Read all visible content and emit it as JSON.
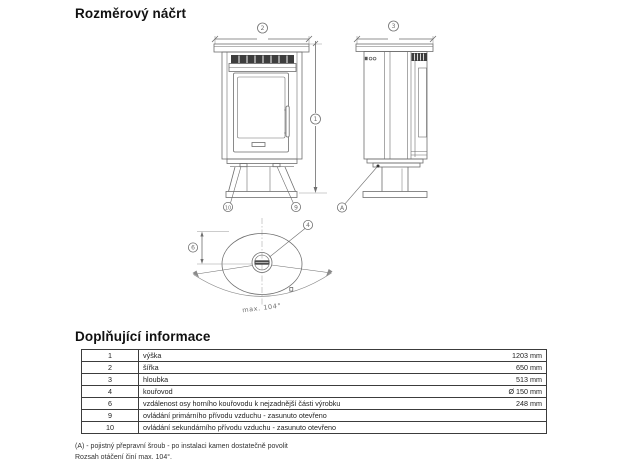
{
  "page": {
    "title": "Rozměrový náčrt",
    "section_title": "Doplňující informace"
  },
  "drawing": {
    "callouts": {
      "height": "1",
      "width": "2",
      "depth": "3",
      "flue": "4",
      "offset": "6",
      "primary_air": "9",
      "secondary_air": "10",
      "transport_screw": "A"
    },
    "rotation_label": "max. 104°"
  },
  "table": {
    "rows": [
      {
        "num": "1",
        "label": "výška",
        "value": "1203 mm"
      },
      {
        "num": "2",
        "label": "šířka",
        "value": "650 mm"
      },
      {
        "num": "3",
        "label": "hloubka",
        "value": "513 mm"
      },
      {
        "num": "4",
        "label": "kouřovod",
        "value": "Ø 150 mm"
      },
      {
        "num": "6",
        "label": "vzdálenost osy horního kouřovodu k nejzadnější části výrobku",
        "value": "248 mm"
      },
      {
        "num": "9",
        "label": "ovládání primárního přívodu vzduchu - zasunuto otevřeno",
        "value": ""
      },
      {
        "num": "10",
        "label": "ovládání sekundárního přívodu vzduchu - zasunuto otevřeno",
        "value": ""
      }
    ]
  },
  "notes": {
    "line1": "(A) - pojistný přepravní šroub - po instalaci kamen dostatečně povolit",
    "line2": "Rozsah otáčení činí max. 104°."
  }
}
